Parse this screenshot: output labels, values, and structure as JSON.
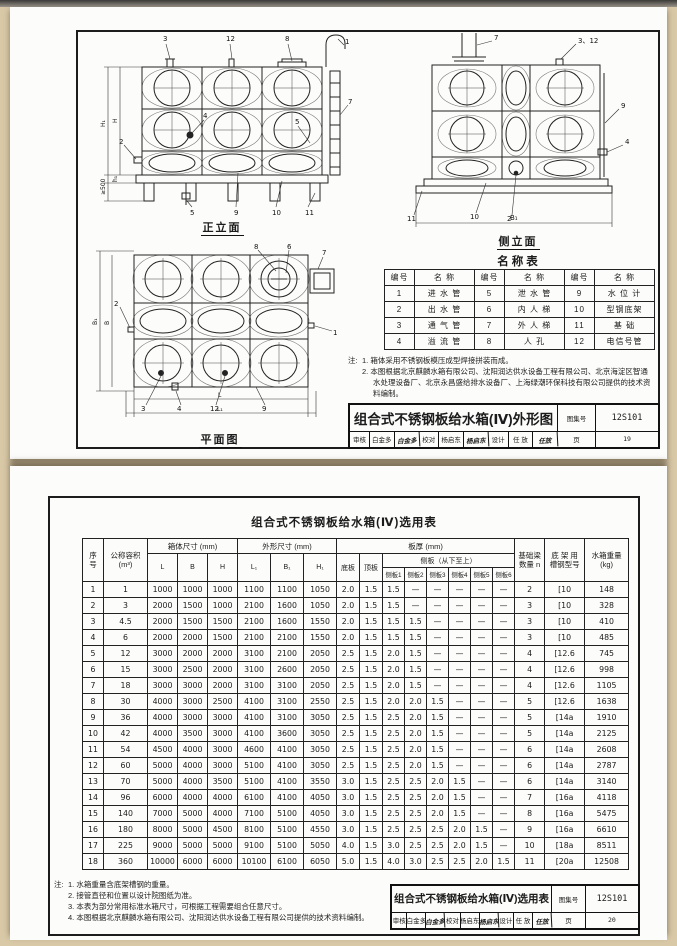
{
  "page1": {
    "front": {
      "title": "正立面",
      "callouts": [
        "3",
        "12",
        "8",
        "1",
        "7",
        "2",
        "4",
        "5",
        "5",
        "9",
        "10",
        "11"
      ],
      "dims": [
        "H₁",
        "H",
        "h₁",
        "≥500"
      ]
    },
    "side": {
      "title": "侧立面",
      "callouts": [
        "7",
        "3、12",
        "9",
        "4",
        "11",
        "10",
        "2"
      ],
      "dims": [
        "B₁"
      ]
    },
    "plan": {
      "title": "平面图",
      "callouts": [
        "8",
        "6",
        "7",
        "1",
        "2",
        "3",
        "4",
        "12",
        "9"
      ],
      "dims": [
        "B₁",
        "B",
        "L",
        "L₁"
      ]
    },
    "name_table": {
      "title": "名称表",
      "headers": [
        "编号",
        "名  称",
        "编号",
        "名  称",
        "编号",
        "名  称"
      ],
      "rows": [
        [
          "1",
          "进 水 管",
          "5",
          "泄 水 管",
          "9",
          "水 位 计"
        ],
        [
          "2",
          "出 水 管",
          "6",
          "内 人 梯",
          "10",
          "型钢底架"
        ],
        [
          "3",
          "通 气 管",
          "7",
          "外 人 梯",
          "11",
          "基   础"
        ],
        [
          "4",
          "溢 流 管",
          "8",
          "人   孔",
          "12",
          "电信号管"
        ]
      ]
    },
    "notes_label": "注:",
    "notes": [
      "1. 箱体采用不锈钢板模压成型焊接拼装而成。",
      "2. 本图根据北京麒麟水箱有限公司、沈阳润达供水设备工程有限公司、北京海淀区智通水处理设备厂、北京永昌盛给排水设备厂、上海绿潮环保科技有限公司提供的技术资料编制。"
    ],
    "title_block": {
      "title": "组合式不锈钢板给水箱(Ⅳ)外形图",
      "atlas_label": "图集号",
      "atlas_no": "12S101",
      "review_label": "审核",
      "reviewer": "白金多",
      "reviewer_sig": "白金多",
      "check_label": "校对",
      "checker": "杨启东",
      "checker_sig": "杨启东",
      "design_label": "设计",
      "designer": "任 放",
      "designer_sig": "任放",
      "page_label": "页",
      "page_no": "19"
    }
  },
  "page2": {
    "table_title": "组合式不锈钢板给水箱(Ⅳ)选用表",
    "header": {
      "seq_top": "序",
      "seq_bottom": "号",
      "volume_line1": "公称容积",
      "volume_line2": "(m³)",
      "box_dims": "箱体尺寸 (mm)",
      "outer_dims": "外形尺寸 (mm)",
      "L": "L",
      "B": "B",
      "H": "H",
      "L1": "L₁",
      "B1": "B₁",
      "H1": "H₁",
      "plate_thickness": "板厚 (mm)",
      "bottom_plate": "底板",
      "top_plate": "顶板",
      "side_plates": "侧板（从下至上）",
      "side1": "侧板1",
      "side2": "侧板2",
      "side3": "侧板3",
      "side4": "侧板4",
      "side5": "侧板5",
      "side6": "侧板6",
      "beam_line1": "基础梁",
      "beam_line2": "数量 n",
      "channel_line1": "底 架 用",
      "channel_line2": "槽钢型号",
      "weight_line1": "水箱重量",
      "weight_line2": "(kg)"
    },
    "rows": [
      [
        "1",
        "1",
        "1000",
        "1000",
        "1000",
        "1100",
        "1100",
        "1050",
        "2.0",
        "1.5",
        "1.5",
        "—",
        "—",
        "—",
        "—",
        "—",
        "2",
        "[10",
        "148"
      ],
      [
        "2",
        "3",
        "2000",
        "1500",
        "1000",
        "2100",
        "1600",
        "1050",
        "2.0",
        "1.5",
        "1.5",
        "—",
        "—",
        "—",
        "—",
        "—",
        "3",
        "[10",
        "328"
      ],
      [
        "3",
        "4.5",
        "2000",
        "1500",
        "1500",
        "2100",
        "1600",
        "1550",
        "2.0",
        "1.5",
        "1.5",
        "1.5",
        "—",
        "—",
        "—",
        "—",
        "3",
        "[10",
        "410"
      ],
      [
        "4",
        "6",
        "2000",
        "2000",
        "1500",
        "2100",
        "2100",
        "1550",
        "2.0",
        "1.5",
        "1.5",
        "1.5",
        "—",
        "—",
        "—",
        "—",
        "3",
        "[10",
        "485"
      ],
      [
        "5",
        "12",
        "3000",
        "2000",
        "2000",
        "3100",
        "2100",
        "2050",
        "2.5",
        "1.5",
        "2.0",
        "1.5",
        "—",
        "—",
        "—",
        "—",
        "4",
        "[12.6",
        "745"
      ],
      [
        "6",
        "15",
        "3000",
        "2500",
        "2000",
        "3100",
        "2600",
        "2050",
        "2.5",
        "1.5",
        "2.0",
        "1.5",
        "—",
        "—",
        "—",
        "—",
        "4",
        "[12.6",
        "998"
      ],
      [
        "7",
        "18",
        "3000",
        "3000",
        "2000",
        "3100",
        "3100",
        "2050",
        "2.5",
        "1.5",
        "2.0",
        "1.5",
        "—",
        "—",
        "—",
        "—",
        "4",
        "[12.6",
        "1105"
      ],
      [
        "8",
        "30",
        "4000",
        "3000",
        "2500",
        "4100",
        "3100",
        "2550",
        "2.5",
        "1.5",
        "2.0",
        "2.0",
        "1.5",
        "—",
        "—",
        "—",
        "5",
        "[12.6",
        "1638"
      ],
      [
        "9",
        "36",
        "4000",
        "3000",
        "3000",
        "4100",
        "3100",
        "3050",
        "2.5",
        "1.5",
        "2.5",
        "2.0",
        "1.5",
        "—",
        "—",
        "—",
        "5",
        "[14a",
        "1910"
      ],
      [
        "10",
        "42",
        "4000",
        "3500",
        "3000",
        "4100",
        "3600",
        "3050",
        "2.5",
        "1.5",
        "2.5",
        "2.0",
        "1.5",
        "—",
        "—",
        "—",
        "5",
        "[14a",
        "2125"
      ],
      [
        "11",
        "54",
        "4500",
        "4000",
        "3000",
        "4600",
        "4100",
        "3050",
        "2.5",
        "1.5",
        "2.5",
        "2.0",
        "1.5",
        "—",
        "—",
        "—",
        "6",
        "[14a",
        "2608"
      ],
      [
        "12",
        "60",
        "5000",
        "4000",
        "3000",
        "5100",
        "4100",
        "3050",
        "2.5",
        "1.5",
        "2.5",
        "2.0",
        "1.5",
        "—",
        "—",
        "—",
        "6",
        "[14a",
        "2787"
      ],
      [
        "13",
        "70",
        "5000",
        "4000",
        "3500",
        "5100",
        "4100",
        "3550",
        "3.0",
        "1.5",
        "2.5",
        "2.5",
        "2.0",
        "1.5",
        "—",
        "—",
        "6",
        "[14a",
        "3140"
      ],
      [
        "14",
        "96",
        "6000",
        "4000",
        "4000",
        "6100",
        "4100",
        "4050",
        "3.0",
        "1.5",
        "2.5",
        "2.5",
        "2.0",
        "1.5",
        "—",
        "—",
        "7",
        "[16a",
        "4118"
      ],
      [
        "15",
        "140",
        "7000",
        "5000",
        "4000",
        "7100",
        "5100",
        "4050",
        "3.0",
        "1.5",
        "2.5",
        "2.5",
        "2.0",
        "1.5",
        "—",
        "—",
        "8",
        "[16a",
        "5475"
      ],
      [
        "16",
        "180",
        "8000",
        "5000",
        "4500",
        "8100",
        "5100",
        "4550",
        "3.0",
        "1.5",
        "2.5",
        "2.5",
        "2.5",
        "2.0",
        "1.5",
        "—",
        "9",
        "[16a",
        "6610"
      ],
      [
        "17",
        "225",
        "9000",
        "5000",
        "5000",
        "9100",
        "5100",
        "5050",
        "4.0",
        "1.5",
        "3.0",
        "2.5",
        "2.5",
        "2.0",
        "1.5",
        "—",
        "10",
        "[18a",
        "8511"
      ],
      [
        "18",
        "360",
        "10000",
        "6000",
        "6000",
        "10100",
        "6100",
        "6050",
        "5.0",
        "1.5",
        "4.0",
        "3.0",
        "2.5",
        "2.5",
        "2.0",
        "1.5",
        "11",
        "[20a",
        "12508"
      ]
    ],
    "notes_label": "注:",
    "notes": [
      "1. 水箱重量含底架槽钢的重量。",
      "2. 接管直径和位置以设计院图纸为准。",
      "3. 本表为部分常用标准水箱尺寸，可根据工程需要组合任意尺寸。",
      "4. 本图根据北京麒麟水箱有限公司、沈阳润达供水设备工程有限公司提供的技术资料编制。"
    ],
    "title_block": {
      "title": "组合式不锈钢板给水箱(Ⅳ)选用表",
      "atlas_label": "图集号",
      "atlas_no": "12S101",
      "review_label": "审核",
      "reviewer": "白金多",
      "reviewer_sig": "白金多",
      "check_label": "校对",
      "checker": "杨启东",
      "checker_sig": "杨启东",
      "design_label": "设计",
      "designer": "任 放",
      "designer_sig": "任放",
      "page_label": "页",
      "page_no": "20"
    }
  }
}
